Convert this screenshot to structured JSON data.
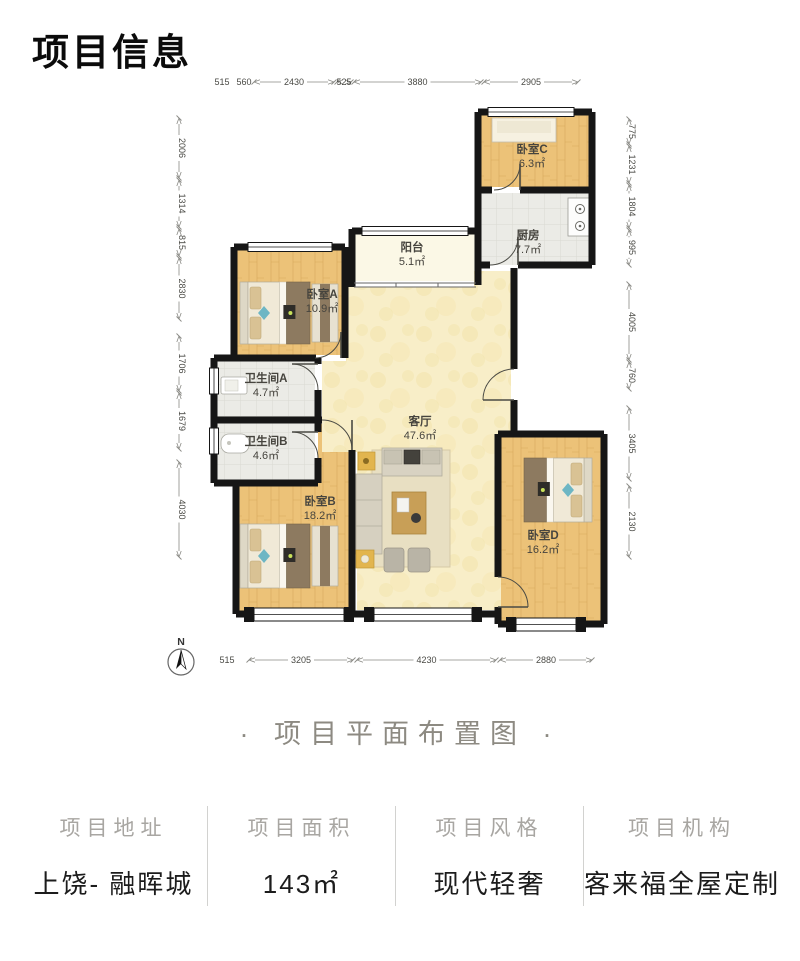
{
  "page": {
    "title": "项目信息",
    "caption": "· 项目平面布置图 ·"
  },
  "compass": {
    "label": "N"
  },
  "floorplan": {
    "rooms": [
      {
        "id": "bedroomC",
        "name": "卧室C",
        "area": "6.3㎡"
      },
      {
        "id": "kitchen",
        "name": "厨房",
        "area": "7.7㎡"
      },
      {
        "id": "balcony",
        "name": "阳台",
        "area": "5.1㎡"
      },
      {
        "id": "bedroomA",
        "name": "卧室A",
        "area": "10.9㎡"
      },
      {
        "id": "bathroomA",
        "name": "卫生间A",
        "area": "4.7㎡"
      },
      {
        "id": "bathroomB",
        "name": "卫生间B",
        "area": "4.6㎡"
      },
      {
        "id": "livingroom",
        "name": "客厅",
        "area": "47.6㎡"
      },
      {
        "id": "bedroomB",
        "name": "卧室B",
        "area": "18.2㎡"
      },
      {
        "id": "bedroomD",
        "name": "卧室D",
        "area": "16.2㎡"
      }
    ],
    "dimensions": {
      "top": [
        "515",
        "560",
        "2430",
        "525",
        "3880",
        "2905"
      ],
      "bottom": [
        "515",
        "3205",
        "4230",
        "2880"
      ],
      "left": [
        "2006",
        "1314",
        "815",
        "2830",
        "1706",
        "1679",
        "4030"
      ],
      "right": [
        "775",
        "1231",
        "1804",
        "995",
        "4005",
        "760",
        "3405",
        "2130"
      ]
    }
  },
  "footer": {
    "columns": [
      {
        "label": "项目地址",
        "value": "上饶- 融晖城"
      },
      {
        "label": "项目面积",
        "value": "143㎡"
      },
      {
        "label": "项目风格",
        "value": "现代轻奢"
      },
      {
        "label": "项目机构",
        "value": "客来福全屋定制"
      }
    ]
  }
}
